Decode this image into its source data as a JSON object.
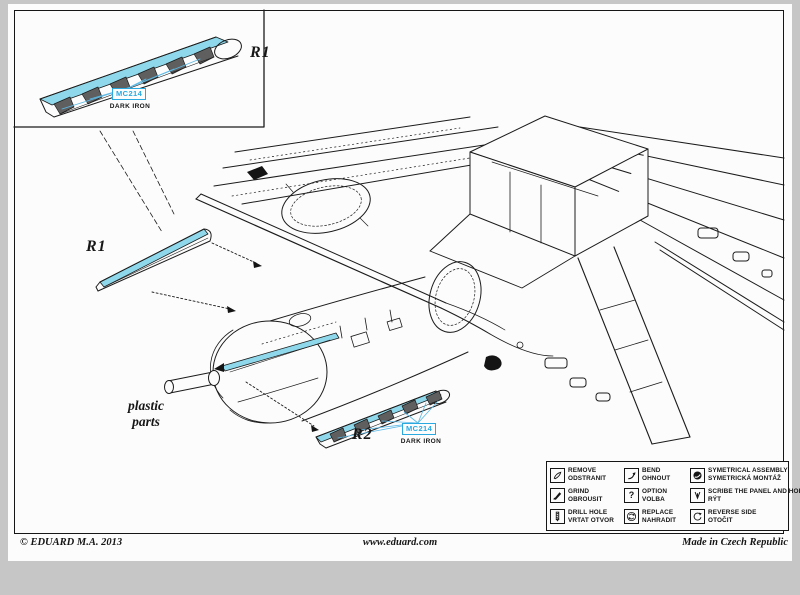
{
  "colors": {
    "highlight": "#8FD8EB",
    "callout_blue": "#29A9E0",
    "ink": "#1b1b1b",
    "paper": "#fcfcfc",
    "margin": "#c6c6c6"
  },
  "inset": {
    "part_label": "R1",
    "paint_code": "MC214",
    "paint_name": "DARK IRON"
  },
  "main": {
    "r1_label": "R1",
    "r2_label": "R2",
    "material_note_line1": "plastic",
    "material_note_line2": "parts",
    "r2_paint_code": "MC214",
    "r2_paint_name": "DARK IRON"
  },
  "legend": {
    "items": [
      {
        "icon": "remove-icon",
        "en": "REMOVE",
        "cz": "ODSTRANIT"
      },
      {
        "icon": "bend-icon",
        "en": "BEND",
        "cz": "OHNOUT"
      },
      {
        "icon": "symmetrical-assembly-icon",
        "en": "SYMETRICAL ASSEMBLY",
        "cz": "SYMETRICKÁ MONTÁŽ"
      },
      {
        "icon": "grind-icon",
        "en": "GRIND",
        "cz": "OBROUSIT"
      },
      {
        "icon": "option-icon",
        "en": "OPTION",
        "cz": "VOLBA",
        "glyph": "?"
      },
      {
        "icon": "scribe-icon",
        "en": "SCRIBE THE PANEL AND HOLES",
        "cz": "RÝT"
      },
      {
        "icon": "drill-hole-icon",
        "en": "DRILL HOLE",
        "cz": "VRTAT OTVOR"
      },
      {
        "icon": "replace-icon",
        "en": "REPLACE",
        "cz": "NAHRADIT"
      },
      {
        "icon": "reverse-side-icon",
        "en": "REVERSE SIDE",
        "cz": "OTOČIT"
      }
    ]
  },
  "footer": {
    "copyright": "© EDUARD  M.A. 2013",
    "website": "www.eduard.com",
    "made_in": "Made in Czech Republic"
  }
}
